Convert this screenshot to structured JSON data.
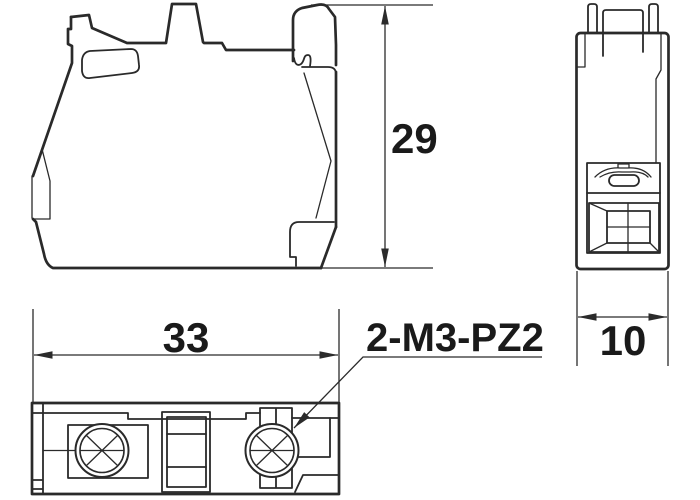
{
  "drawing": {
    "views": {
      "front": "front-view",
      "side": "side-view",
      "bottom": "bottom-view"
    },
    "dimensions": {
      "height": {
        "value": "29"
      },
      "width": {
        "value": "33"
      },
      "depth": {
        "value": "10"
      }
    },
    "callout": {
      "label": "2-M3-PZ2"
    },
    "colors": {
      "line": "#2a2a2a",
      "text": "#1a1a1a",
      "background": "#ffffff"
    }
  }
}
